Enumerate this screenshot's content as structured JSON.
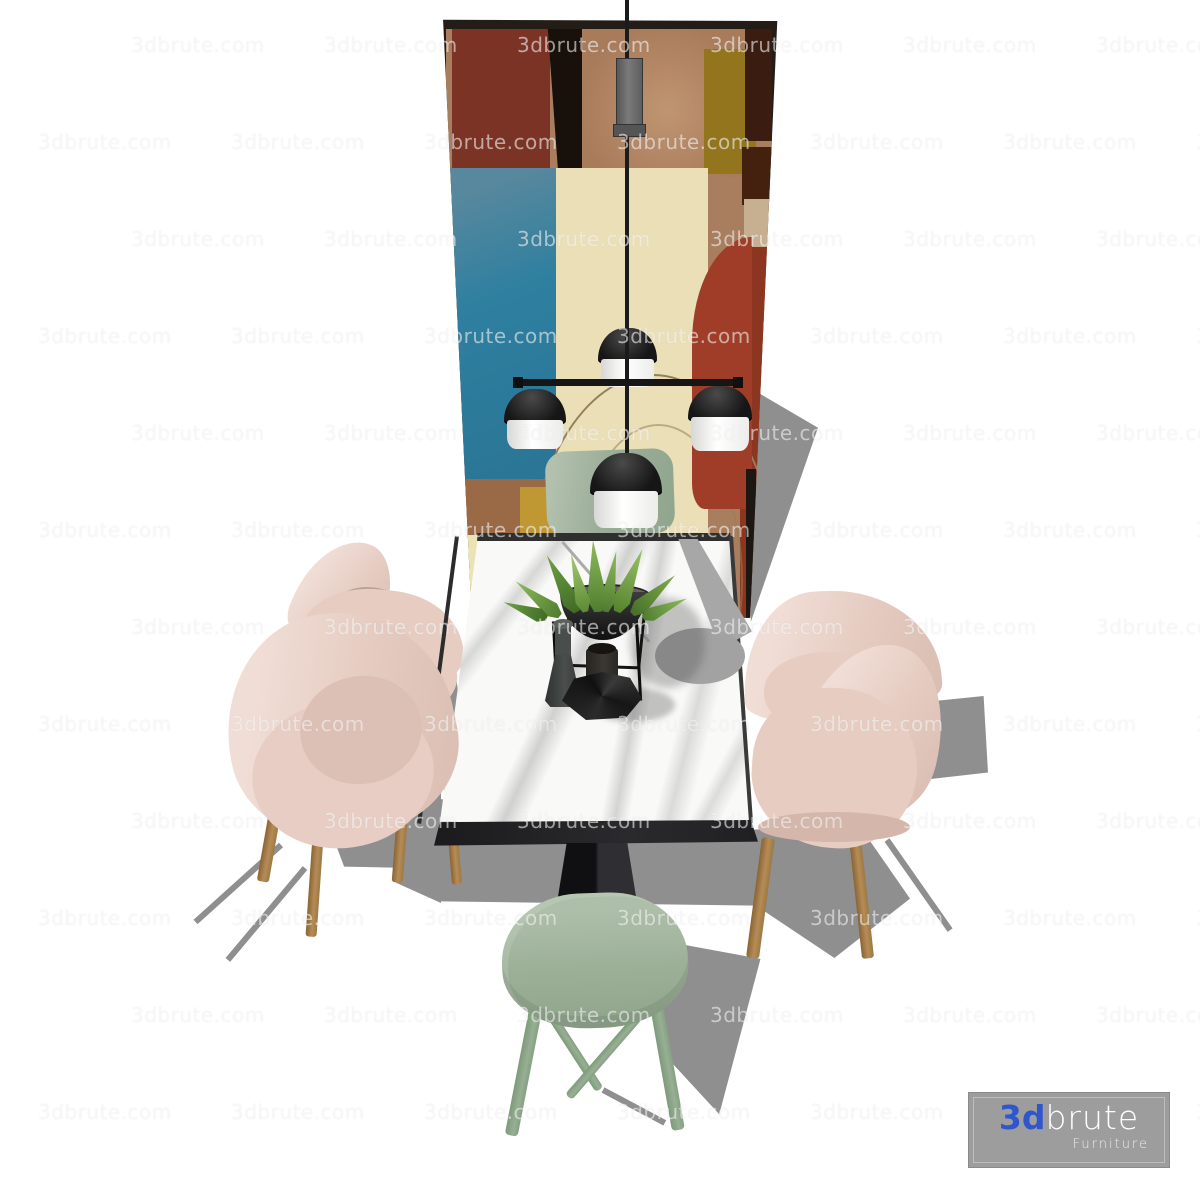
{
  "watermark": {
    "text": "3dbrute.com"
  },
  "logo": {
    "brand_3d": "3d",
    "brand_rest": "brute",
    "subtitle": "Furniture",
    "accent_color": "#2f56cc",
    "box_color": "#9d9d9d"
  },
  "palette": {
    "floor": "#ffffff",
    "chair_pink": "#e5ccc2",
    "chair_pink_highlight": "#f0ddd5",
    "chair_inner_taupe": "#b5a093",
    "wood_leg": "#b08a55",
    "stool_green": "#9fb39b",
    "bench_green": "#9cae9a",
    "marble_top": "#f9f9f8",
    "table_black": "#242426",
    "lamp_black": "#1b1b1b",
    "lamp_shade_white": "#fdfdfd",
    "shadow_gray": "#8f8f8f",
    "art_teal": "#2e7fa0",
    "art_maroon": "#7b3325",
    "art_cream": "#ebdfb7",
    "art_red": "#a03d28",
    "art_olive": "#92751d",
    "art_tan": "#a87b5a"
  }
}
